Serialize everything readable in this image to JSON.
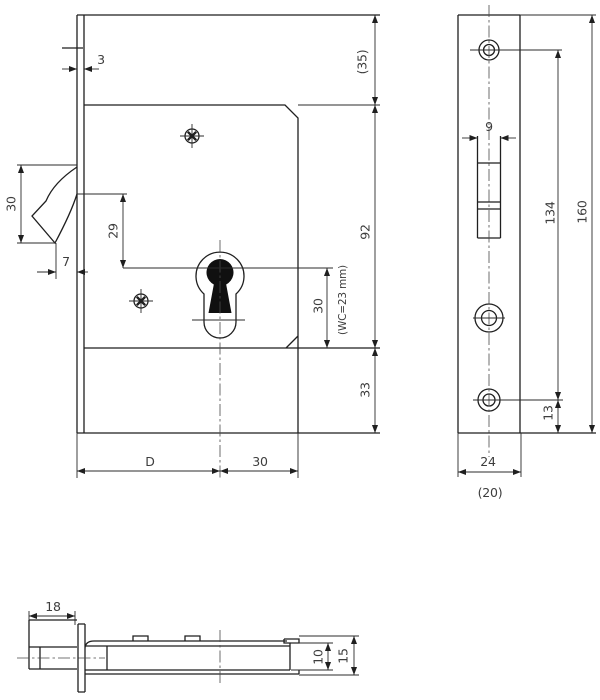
{
  "meta": {
    "title": "Sliding-door hook lock technical drawing"
  },
  "front": {
    "plate_thickness": "3",
    "hook_height": "30",
    "hook_tip_offset": "7",
    "hook_to_keyhole": "29",
    "top_margin": "(35)",
    "case_height": "92",
    "bottom_margin": "33",
    "keyhole_height": "30",
    "wc_note": "(WC=23 mm)",
    "backset": "D",
    "keyhole_to_edge": "30"
  },
  "face": {
    "slot_width": "9",
    "screw_span": "134",
    "plate_height": "160",
    "bottom_screw_offset": "13",
    "plate_width": "24",
    "case_width_ref": "(20)"
  },
  "side": {
    "bolt_protrusion": "18",
    "case_thickness": "10",
    "overall_thickness": "15"
  }
}
